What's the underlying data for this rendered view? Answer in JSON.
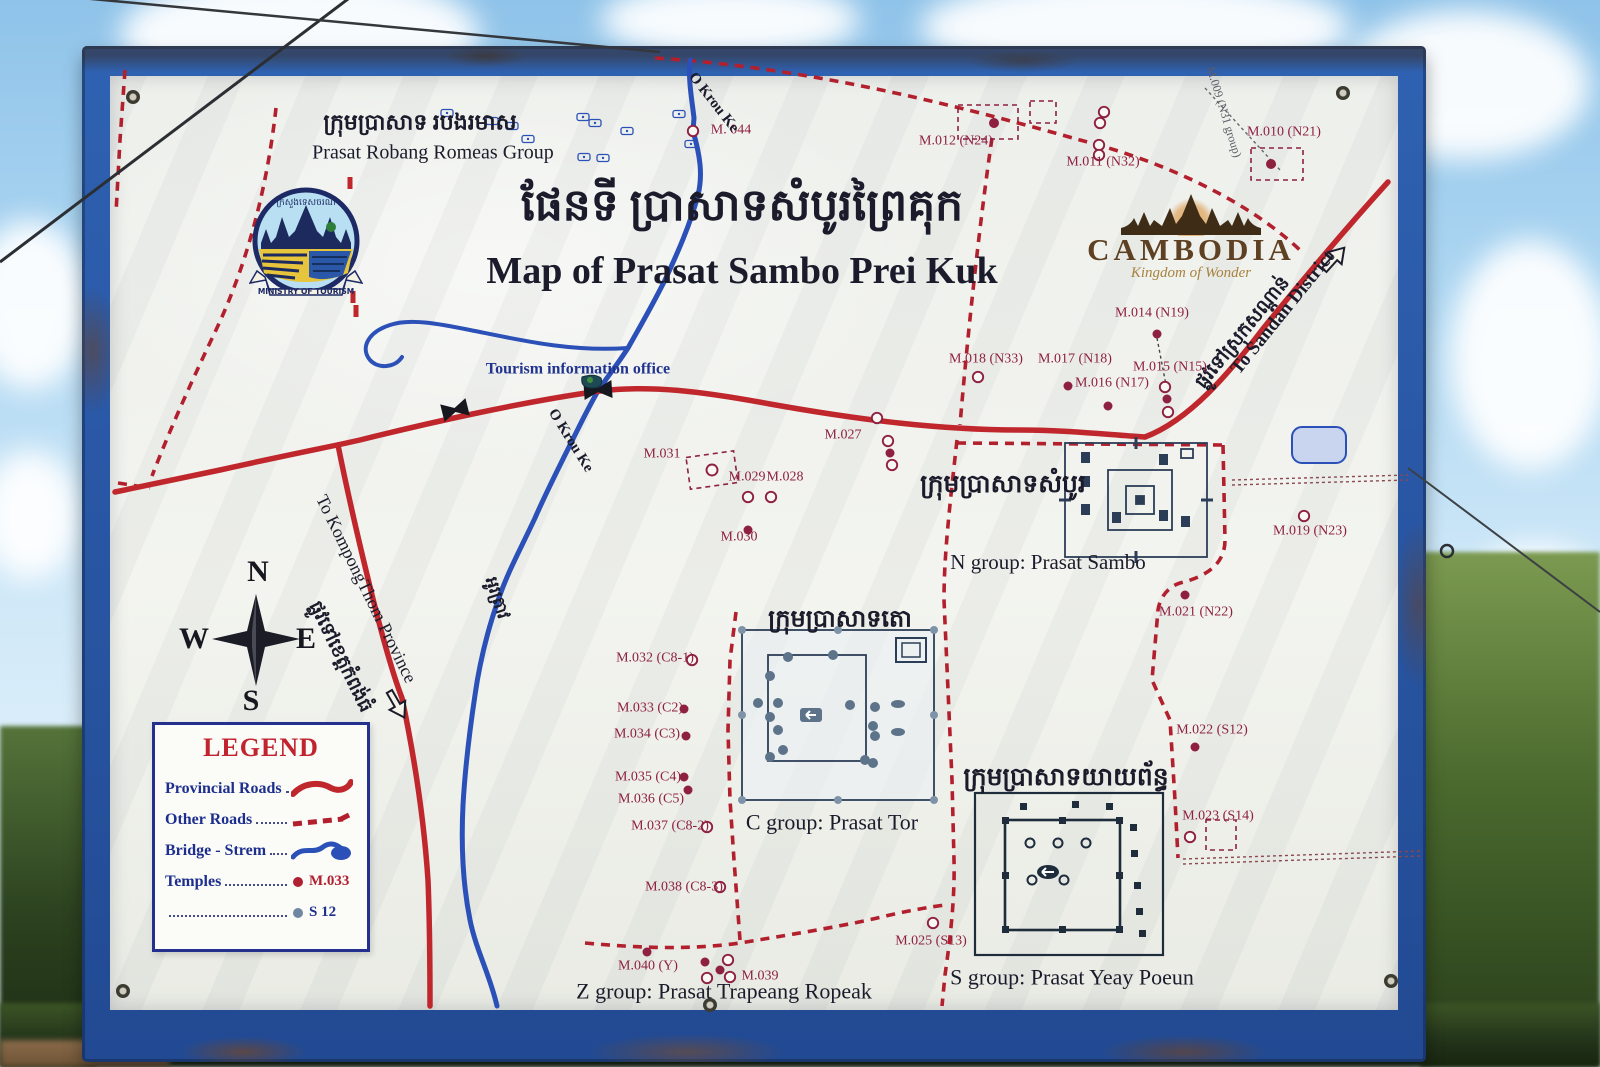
{
  "colors": {
    "roadSolid": "#c0272d",
    "roadDash": "#b21f2d",
    "river": "#2b50b7",
    "maroon": "#8e2040",
    "ink": "#1b1b2b",
    "blue": "#20338f",
    "dim": "#5c5c66",
    "frame": "#2a57a8",
    "slate": "#5c7389",
    "inset": "#2c3e57",
    "pondFill": "#c9d4ee"
  },
  "sign": {
    "title_khmer": "ផែនទី ប្រាសាទសំបូរព្រៃគុក",
    "title_en": "Map of Prasat Sambo Prei Kuk",
    "logos": {
      "ministry": {
        "ribbon": "MINISTRY OF TOURISM",
        "khmer_arc": "ក្រសួងទេសចរណ៍"
      },
      "cambodia": {
        "name": "CAMBODIA",
        "tagline": "Kingdom of Wonder"
      }
    },
    "legend": {
      "title": "LEGEND",
      "items": [
        {
          "label": "Provincial Roads"
        },
        {
          "label": "Other Roads"
        },
        {
          "label": "Bridge - Strem"
        },
        {
          "label": "Temples",
          "sample": "M.033"
        },
        {
          "label": "",
          "sample": "S 12"
        }
      ]
    },
    "compass": {
      "n": "N",
      "e": "E",
      "s": "S",
      "w": "W"
    }
  },
  "map": {
    "labels": [
      {
        "id": "robang-khmer",
        "text": "ក្រុមប្រាសាទ របងរមាស",
        "x": 420,
        "y": 122,
        "fs": 22,
        "c": "ink",
        "b": 1
      },
      {
        "id": "robang-en",
        "text": "Prasat Robang Romeas Group",
        "x": 433,
        "y": 153,
        "fs": 20,
        "c": "ink"
      },
      {
        "id": "title-khmer",
        "text": "ផែនទី ប្រាសាទសំបូរព្រៃគុក",
        "x": 742,
        "y": 206,
        "fs": 44,
        "c": "ink",
        "b": 1
      },
      {
        "id": "title-en",
        "text": "Map of Prasat Sambo Prei Kuk",
        "x": 742,
        "y": 272,
        "fs": 38,
        "c": "ink",
        "b": 1
      },
      {
        "id": "m044",
        "text": "M. 044",
        "x": 731,
        "y": 131,
        "fs": 14,
        "c": "maroon"
      },
      {
        "id": "okrouke-top",
        "text": "O Krou Ke",
        "x": 713,
        "y": 103,
        "fs": 15,
        "c": "ink",
        "b": 1,
        "rot": 52
      },
      {
        "id": "m009",
        "text": "M.009 (N31 group)",
        "x": 1224,
        "y": 112,
        "fs": 12,
        "c": "dim",
        "rot": 73
      },
      {
        "id": "m012",
        "text": "M.012 (N24)",
        "x": 956,
        "y": 142,
        "fs": 14,
        "c": "maroon"
      },
      {
        "id": "m011",
        "text": "M.011 (N32)",
        "x": 1103,
        "y": 163,
        "fs": 14,
        "c": "maroon"
      },
      {
        "id": "m010",
        "text": "M.010 (N21)",
        "x": 1284,
        "y": 133,
        "fs": 14,
        "c": "maroon"
      },
      {
        "id": "sandan-khmer",
        "text": "ផ្លូវទៅស្រុកសណ្ដាន់",
        "x": 1243,
        "y": 333,
        "fs": 19,
        "c": "ink",
        "b": 1,
        "rot": -51
      },
      {
        "id": "sandan-en",
        "text": "To Sandan District",
        "x": 1283,
        "y": 313,
        "fs": 19,
        "c": "ink",
        "b": 1,
        "rot": -51
      },
      {
        "id": "m014",
        "text": "M.014 (N19)",
        "x": 1152,
        "y": 314,
        "fs": 14,
        "c": "maroon"
      },
      {
        "id": "m018",
        "text": "M.018 (N33)",
        "x": 986,
        "y": 360,
        "fs": 14,
        "c": "maroon"
      },
      {
        "id": "m017",
        "text": "M.017 (N18)",
        "x": 1075,
        "y": 360,
        "fs": 14,
        "c": "maroon"
      },
      {
        "id": "m015",
        "text": "M.015 (N15)",
        "x": 1170,
        "y": 368,
        "fs": 14,
        "c": "maroon"
      },
      {
        "id": "m016",
        "text": "M.016 (N17)",
        "x": 1112,
        "y": 384,
        "fs": 14,
        "c": "maroon"
      },
      {
        "id": "tourism-office",
        "text": "Tourism information office",
        "x": 578,
        "y": 370,
        "fs": 16,
        "c": "blue",
        "b": 1
      },
      {
        "id": "m027",
        "text": "M.027",
        "x": 843,
        "y": 436,
        "fs": 14,
        "c": "maroon"
      },
      {
        "id": "m031",
        "text": "M.031",
        "x": 662,
        "y": 455,
        "fs": 14,
        "c": "maroon"
      },
      {
        "id": "m029",
        "text": "M.029",
        "x": 747,
        "y": 478,
        "fs": 14,
        "c": "maroon"
      },
      {
        "id": "m028",
        "text": "M.028",
        "x": 785,
        "y": 478,
        "fs": 14,
        "c": "maroon"
      },
      {
        "id": "m030",
        "text": "M.030",
        "x": 739,
        "y": 538,
        "fs": 14,
        "c": "maroon"
      },
      {
        "id": "ngroup-khmer",
        "text": "ក្រុមប្រាសាទសំបូរ",
        "x": 1003,
        "y": 485,
        "fs": 25,
        "c": "ink",
        "b": 1
      },
      {
        "id": "ngroup-en",
        "text": "N group: Prasat Sambo",
        "x": 1048,
        "y": 562,
        "fs": 21,
        "c": "ink"
      },
      {
        "id": "m019",
        "text": "M.019 (N23)",
        "x": 1310,
        "y": 532,
        "fs": 14,
        "c": "maroon"
      },
      {
        "id": "okrouke-mid",
        "text": "O Krou Ke",
        "x": 570,
        "y": 441,
        "fs": 15,
        "c": "ink",
        "b": 1,
        "rot": 58
      },
      {
        "id": "kampong-en",
        "text": "To KompongThom Province",
        "x": 366,
        "y": 589,
        "fs": 18,
        "c": "ink",
        "rot": 64
      },
      {
        "id": "kampong-khmer",
        "text": "ផ្លូវទៅខេត្តកំពង់ធំ",
        "x": 340,
        "y": 657,
        "fs": 19,
        "c": "ink",
        "b": 1,
        "rot": 64
      },
      {
        "id": "m021",
        "text": "M.021 (N22)",
        "x": 1196,
        "y": 613,
        "fs": 14,
        "c": "maroon"
      },
      {
        "id": "river-khmer",
        "text": "អូរត្រាវ",
        "x": 497,
        "y": 598,
        "fs": 17,
        "c": "ink",
        "b": 1,
        "rot": 72
      },
      {
        "id": "cgroup-khmer",
        "text": "ក្រុមប្រាសាទតោ",
        "x": 840,
        "y": 620,
        "fs": 24,
        "c": "ink",
        "b": 1
      },
      {
        "id": "m032",
        "text": "M.032 (C8-1)",
        "x": 655,
        "y": 659,
        "fs": 14,
        "c": "maroon"
      },
      {
        "id": "m033",
        "text": "M.033 (C2)",
        "x": 650,
        "y": 709,
        "fs": 14,
        "c": "maroon"
      },
      {
        "id": "m034",
        "text": "M.034 (C3)",
        "x": 647,
        "y": 735,
        "fs": 14,
        "c": "maroon"
      },
      {
        "id": "m035",
        "text": "M.035 (C4)",
        "x": 648,
        "y": 778,
        "fs": 14,
        "c": "maroon"
      },
      {
        "id": "m036",
        "text": "M.036 (C5)",
        "x": 651,
        "y": 800,
        "fs": 14,
        "c": "maroon"
      },
      {
        "id": "m037",
        "text": "M.037 (C8-2)",
        "x": 670,
        "y": 827,
        "fs": 14,
        "c": "maroon"
      },
      {
        "id": "m038",
        "text": "M.038 (C8-3)",
        "x": 684,
        "y": 888,
        "fs": 14,
        "c": "maroon"
      },
      {
        "id": "cgroup-en",
        "text": "C group: Prasat Tor",
        "x": 832,
        "y": 822,
        "fs": 22,
        "c": "ink"
      },
      {
        "id": "m022",
        "text": "M.022 (S12)",
        "x": 1212,
        "y": 731,
        "fs": 14,
        "c": "maroon"
      },
      {
        "id": "sgroup-khmer",
        "text": "ក្រុមប្រាសាទយាយព័ន្ធ",
        "x": 1066,
        "y": 778,
        "fs": 25,
        "c": "ink",
        "b": 1
      },
      {
        "id": "m023",
        "text": "M.023 (S14)",
        "x": 1218,
        "y": 817,
        "fs": 14,
        "c": "maroon"
      },
      {
        "id": "m025",
        "text": "M.025 (S13)",
        "x": 931,
        "y": 942,
        "fs": 14,
        "c": "maroon"
      },
      {
        "id": "m040",
        "text": "M.040 (Y)",
        "x": 648,
        "y": 967,
        "fs": 14,
        "c": "maroon"
      },
      {
        "id": "m039",
        "text": "M.039",
        "x": 760,
        "y": 977,
        "fs": 14,
        "c": "maroon"
      },
      {
        "id": "zgroup-en",
        "text": "Z group: Prasat Trapeang Ropeak",
        "x": 724,
        "y": 991,
        "fs": 22,
        "c": "ink"
      },
      {
        "id": "sgroup-en",
        "text": "S group: Prasat Yeay Poeun",
        "x": 1072,
        "y": 977,
        "fs": 22,
        "c": "ink"
      }
    ],
    "markers": [
      {
        "x": 693,
        "y": 131,
        "t": "o"
      },
      {
        "x": 447,
        "y": 113,
        "t": "tb"
      },
      {
        "x": 492,
        "y": 121,
        "t": "tb"
      },
      {
        "x": 512,
        "y": 126,
        "t": "tb"
      },
      {
        "x": 583,
        "y": 117,
        "t": "tb"
      },
      {
        "x": 595,
        "y": 123,
        "t": "tb"
      },
      {
        "x": 584,
        "y": 157,
        "t": "tb"
      },
      {
        "x": 603,
        "y": 158,
        "t": "tb"
      },
      {
        "x": 528,
        "y": 139,
        "t": "tb"
      },
      {
        "x": 627,
        "y": 131,
        "t": "tb"
      },
      {
        "x": 679,
        "y": 114,
        "t": "tb"
      },
      {
        "x": 691,
        "y": 144,
        "t": "tb"
      },
      {
        "x": 988,
        "y": 122,
        "t": "rf"
      },
      {
        "x": 1043,
        "y": 112,
        "t": "sq"
      },
      {
        "x": 1104,
        "y": 112,
        "t": "o"
      },
      {
        "x": 1100,
        "y": 123,
        "t": "o"
      },
      {
        "x": 1099,
        "y": 145,
        "t": "o"
      },
      {
        "x": 1099,
        "y": 155,
        "t": "o"
      },
      {
        "x": 1277,
        "y": 164,
        "t": "rf2"
      },
      {
        "x": 1157,
        "y": 334,
        "t": "f"
      },
      {
        "x": 978,
        "y": 377,
        "t": "o"
      },
      {
        "x": 1068,
        "y": 386,
        "t": "f"
      },
      {
        "x": 1108,
        "y": 406,
        "t": "f"
      },
      {
        "x": 1165,
        "y": 387,
        "t": "o"
      },
      {
        "x": 1167,
        "y": 399,
        "t": "f"
      },
      {
        "x": 1168,
        "y": 412,
        "t": "o"
      },
      {
        "x": 877,
        "y": 418,
        "t": "o"
      },
      {
        "x": 888,
        "y": 441,
        "t": "o"
      },
      {
        "x": 890,
        "y": 453,
        "t": "f"
      },
      {
        "x": 892,
        "y": 465,
        "t": "o"
      },
      {
        "x": 712,
        "y": 470,
        "t": "ro"
      },
      {
        "x": 748,
        "y": 497,
        "t": "o"
      },
      {
        "x": 771,
        "y": 497,
        "t": "o"
      },
      {
        "x": 748,
        "y": 530,
        "t": "f"
      },
      {
        "x": 1304,
        "y": 516,
        "t": "o"
      },
      {
        "x": 1185,
        "y": 595,
        "t": "f"
      },
      {
        "x": 1195,
        "y": 747,
        "t": "f"
      },
      {
        "x": 1190,
        "y": 837,
        "t": "o"
      },
      {
        "x": 1221,
        "y": 835,
        "t": "sq2"
      },
      {
        "x": 692,
        "y": 660,
        "t": "o"
      },
      {
        "x": 684,
        "y": 709,
        "t": "f"
      },
      {
        "x": 686,
        "y": 736,
        "t": "f"
      },
      {
        "x": 684,
        "y": 777,
        "t": "f"
      },
      {
        "x": 688,
        "y": 790,
        "t": "f"
      },
      {
        "x": 707,
        "y": 827,
        "t": "o"
      },
      {
        "x": 720,
        "y": 887,
        "t": "o"
      },
      {
        "x": 933,
        "y": 923,
        "t": "o"
      },
      {
        "x": 647,
        "y": 952,
        "t": "f"
      },
      {
        "x": 705,
        "y": 962,
        "t": "f"
      },
      {
        "x": 728,
        "y": 960,
        "t": "o"
      },
      {
        "x": 720,
        "y": 970,
        "t": "f"
      },
      {
        "x": 707,
        "y": 978,
        "t": "o"
      },
      {
        "x": 730,
        "y": 977,
        "t": "o"
      },
      {
        "x": 350,
        "y": 183,
        "t": "rd"
      },
      {
        "x": 353,
        "y": 297,
        "t": "rd"
      },
      {
        "x": 356,
        "y": 311,
        "t": "rd"
      }
    ]
  }
}
